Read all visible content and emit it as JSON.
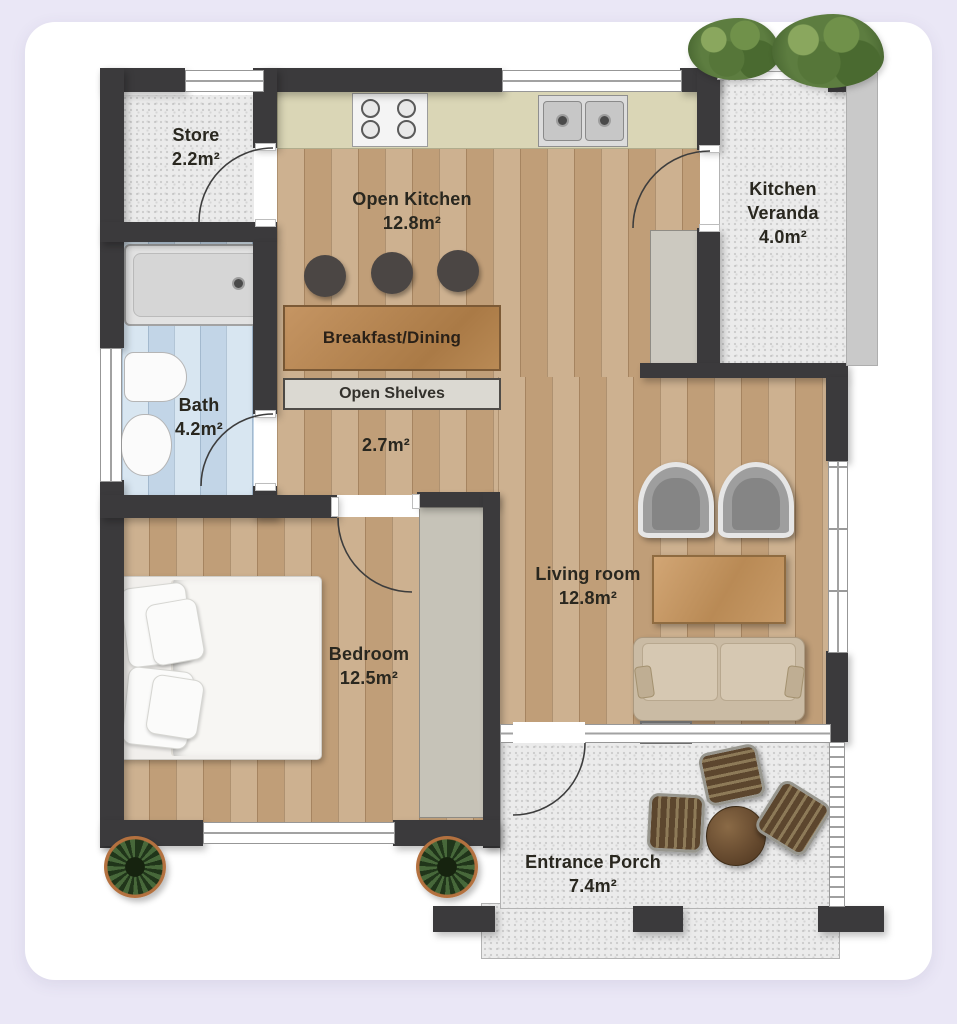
{
  "colors": {
    "page_background": "#eae7f6",
    "card_background": "#ffffff",
    "wall": "#3b3a3c",
    "wood_floor": "#c8ab87",
    "bath_floor": "#cfe0ee",
    "hard_floor": "#ebebeb",
    "counter": "#dad6b6",
    "bar_wood": "#b98a55",
    "label_text": "#29271f"
  },
  "labels": {
    "store": [
      "Store",
      "2.2m²"
    ],
    "open_kitchen": [
      "Open Kitchen",
      "12.8m²"
    ],
    "kitchen_veranda": [
      "Kitchen",
      "Veranda",
      "4.0m²"
    ],
    "bath": [
      "Bath",
      "4.2m²"
    ],
    "hallway": [
      "2.7m²"
    ],
    "bedroom": [
      "Bedroom",
      "12.5m²"
    ],
    "living_room": [
      "Living room",
      "12.8m²"
    ],
    "entrance_porch": [
      "Entrance Porch",
      "7.4m²"
    ],
    "breakfast_bar": "Breakfast/Dining",
    "open_shelves": "Open Shelves"
  }
}
